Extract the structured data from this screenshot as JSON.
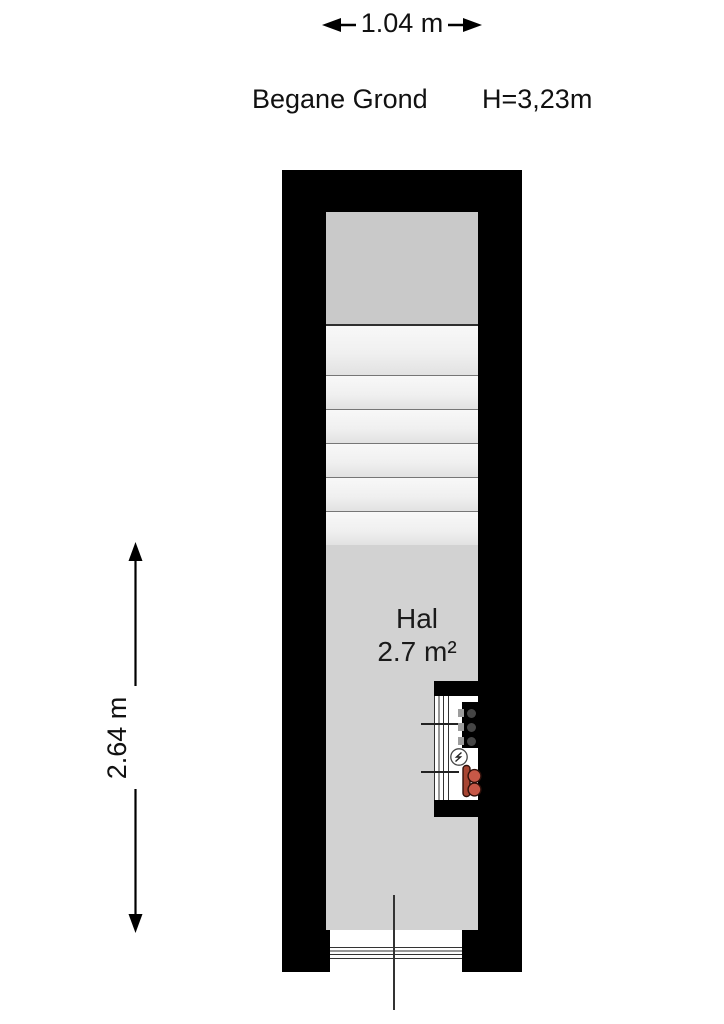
{
  "title": {
    "floor_name": "Begane Grond",
    "ceiling_height": "H=3,23m"
  },
  "dimensions": {
    "width_label": "1.04 m",
    "height_label": "2.64 m"
  },
  "room": {
    "name": "Hal",
    "area": "2.7 m²"
  },
  "features": {
    "stair_tread_count": 6,
    "meter_cupboard": [
      "fuse-box",
      "electricity-meter",
      "gas-water-meter"
    ],
    "door": "bottom-center opening with threshold"
  },
  "colors": {
    "wall": "#000000",
    "stair_landing": "#c9c9c9",
    "stairs": "#f0f0f0",
    "hall_floor": "#d2d2d2",
    "meter_circle_red": "#c75847",
    "meter_bar_red": "#a84532"
  }
}
